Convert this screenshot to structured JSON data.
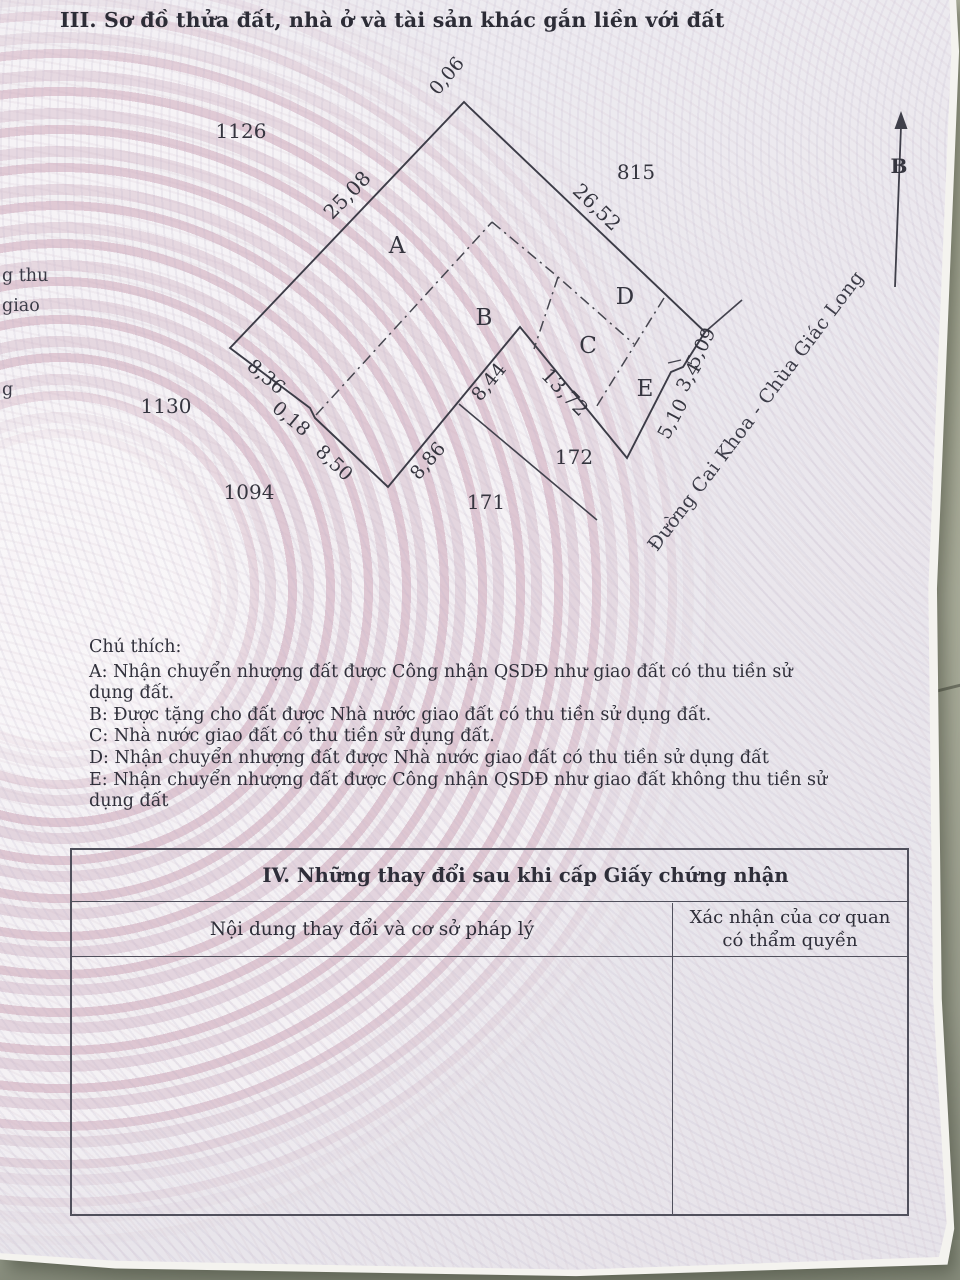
{
  "colors": {
    "paper": "#eae7ee",
    "pattern_pink": "#d9b9c6",
    "ink": "#35353f",
    "wall": "#b9bda1",
    "desk": "#969a8b"
  },
  "section3": {
    "title": "III. Sơ đồ thửa đất, nhà ở và tài sản khác gắn liền với đất"
  },
  "left_edge_fragments": [
    {
      "text": "g thu",
      "x": 2,
      "y": 266
    },
    {
      "text": "giao",
      "x": 2,
      "y": 296
    },
    {
      "text": "g",
      "x": 2,
      "y": 380
    }
  ],
  "diagram": {
    "north_label": "B",
    "road_label": "Đường Cai Khoa - Chùa Giác Long",
    "parcel_labels": [
      {
        "text": "A",
        "x": 397,
        "y": 246
      },
      {
        "text": "B",
        "x": 484,
        "y": 318
      },
      {
        "text": "C",
        "x": 588,
        "y": 346
      },
      {
        "text": "D",
        "x": 625,
        "y": 297
      },
      {
        "text": "E",
        "x": 645,
        "y": 389
      }
    ],
    "neighbor_labels": [
      {
        "text": "1126",
        "x": 241,
        "y": 131
      },
      {
        "text": "815",
        "x": 636,
        "y": 172
      },
      {
        "text": "1130",
        "x": 166,
        "y": 406
      },
      {
        "text": "1094",
        "x": 249,
        "y": 492
      },
      {
        "text": "171",
        "x": 486,
        "y": 502
      },
      {
        "text": "172",
        "x": 574,
        "y": 457
      }
    ],
    "dimensions": [
      {
        "text": "0,06",
        "x": 447,
        "y": 76,
        "rot": -50
      },
      {
        "text": "25,08",
        "x": 347,
        "y": 195,
        "rot": -46,
        "fs": 20
      },
      {
        "text": "26,52",
        "x": 597,
        "y": 207,
        "rot": 44,
        "fs": 20
      },
      {
        "text": "8,36",
        "x": 266,
        "y": 377,
        "rot": 40
      },
      {
        "text": "0,18",
        "x": 291,
        "y": 419,
        "rot": 40
      },
      {
        "text": "8,50",
        "x": 334,
        "y": 463,
        "rot": 43
      },
      {
        "text": "8,86",
        "x": 428,
        "y": 461,
        "rot": -49
      },
      {
        "text": "8,44",
        "x": 489,
        "y": 382,
        "rot": -51
      },
      {
        "text": "13,72",
        "x": 565,
        "y": 392,
        "rot": 46,
        "fs": 20
      },
      {
        "text": "5,10",
        "x": 673,
        "y": 419,
        "rot": -62
      },
      {
        "text": "3,4",
        "x": 689,
        "y": 377,
        "rot": -60
      },
      {
        "text": "5,09",
        "x": 701,
        "y": 348,
        "rot": -63
      }
    ]
  },
  "legend": {
    "heading": "Chú thích:",
    "items": [
      "A: Nhận chuyển nhượng đất được Công nhận QSDĐ như giao đất có thu tiền sử dụng đất.",
      "B: Được tặng cho đất được Nhà nước giao đất có thu tiền sử dụng đất.",
      "C: Nhà nước giao đất có thu tiền sử dụng đất.",
      "D: Nhận chuyển nhượng đất được Nhà nước giao đất có thu tiền sử dụng đất",
      "E: Nhận chuyển nhượng đất được Công nhận QSDĐ như giao đất không thu tiền sử dụng đất"
    ]
  },
  "section4": {
    "title": "IV. Những thay đổi sau khi cấp Giấy chứng nhận",
    "col1_header": "Nội dung thay đổi và cơ sở pháp lý",
    "col2_header": "Xác nhận của cơ quan có thẩm quyền"
  }
}
